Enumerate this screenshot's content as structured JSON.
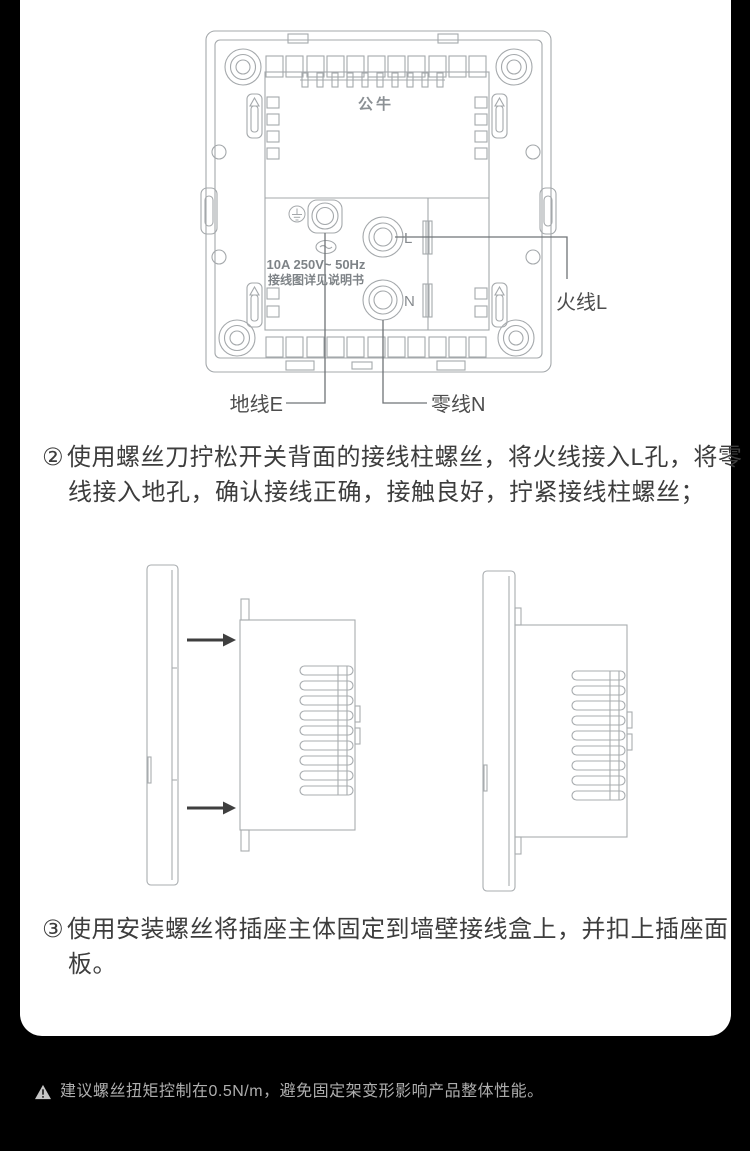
{
  "wiring_diagram": {
    "brand": "公牛",
    "rating_line1": "10A 250V~ 50Hz",
    "rating_line2": "接线图详见说明书",
    "terminal_l": "L",
    "terminal_n": "N",
    "label_live": "火线L",
    "label_earth": "地线E",
    "label_neutral": "零线N"
  },
  "steps": [
    {
      "num": "②",
      "text": "使用螺丝刀拧松开关背面的接线柱螺丝，将火线接入L孔，将零线接入地孔，确认接线正确，接触良好，拧紧接线柱螺丝；"
    },
    {
      "num": "③",
      "text": "使用安装螺丝将插座主体固定到墙壁接线盒上，并扣上插座面板。"
    }
  ],
  "footer": {
    "warning": "建议螺丝扭矩控制在0.5N/m，避免固定架变形影响产品整体性能。"
  },
  "colors": {
    "page_bg": "#000000",
    "card_bg": "#ffffff",
    "drawing_line": "#a4a8ab",
    "leader_line": "#6f7477",
    "label_text": "#4d4d4d",
    "body_text": "#3d3d3d",
    "footer_text": "#aeaeae"
  }
}
